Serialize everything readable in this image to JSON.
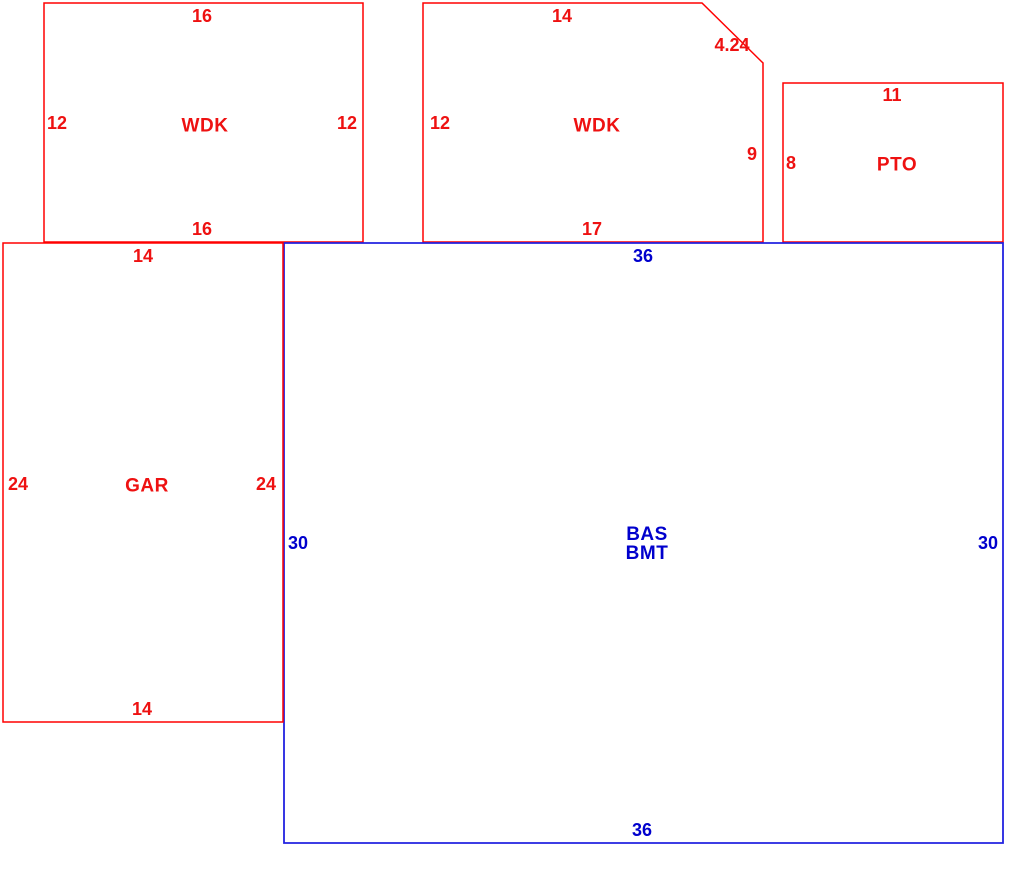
{
  "canvas": {
    "width": 1035,
    "height": 882,
    "background": "#ffffff"
  },
  "colors": {
    "exterior_red_line": "#ff0000",
    "exterior_red_text": "#ee1111",
    "main_blue_line": "#2222e0",
    "main_blue_text": "#0000cd"
  },
  "areas": [
    {
      "id": "wdk-left",
      "type": "wood-deck",
      "label_lines": [
        "WDK"
      ],
      "line_color": "#ff0000",
      "text_color": "#ee1111",
      "stroke_width": 1.5,
      "points": "44,3 363,3 363,242 44,242",
      "label_pos": {
        "x": 205,
        "y": 126
      },
      "dims": [
        {
          "text": "16",
          "x": 202,
          "y": 16,
          "side": "top"
        },
        {
          "text": "12",
          "x": 57,
          "y": 123,
          "side": "left"
        },
        {
          "text": "12",
          "x": 347,
          "y": 123,
          "side": "right"
        },
        {
          "text": "16",
          "x": 202,
          "y": 229,
          "side": "bottom"
        }
      ]
    },
    {
      "id": "wdk-mid",
      "type": "wood-deck",
      "label_lines": [
        "WDK"
      ],
      "line_color": "#ff0000",
      "text_color": "#ee1111",
      "stroke_width": 1.5,
      "points": "423,3 702,3 763,63 763,242 423,242",
      "label_pos": {
        "x": 597,
        "y": 126
      },
      "dims": [
        {
          "text": "14",
          "x": 562,
          "y": 16,
          "side": "top"
        },
        {
          "text": "4.24",
          "x": 732,
          "y": 45,
          "side": "diagonal"
        },
        {
          "text": "12",
          "x": 440,
          "y": 123,
          "side": "left"
        },
        {
          "text": "9",
          "x": 752,
          "y": 154,
          "side": "right"
        },
        {
          "text": "17",
          "x": 592,
          "y": 229,
          "side": "bottom"
        }
      ]
    },
    {
      "id": "pto",
      "type": "patio",
      "label_lines": [
        "PTO"
      ],
      "line_color": "#ff0000",
      "text_color": "#ee1111",
      "stroke_width": 1.5,
      "points": "783,83 1003,83 1003,242 783,242",
      "label_pos": {
        "x": 897,
        "y": 165
      },
      "dims": [
        {
          "text": "11",
          "x": 892,
          "y": 95,
          "side": "top"
        },
        {
          "text": "8",
          "x": 791,
          "y": 163,
          "side": "left"
        }
      ]
    },
    {
      "id": "bas-bmt",
      "type": "base-with-basement",
      "label_lines": [
        "BAS",
        "BMT"
      ],
      "line_color": "#2222e0",
      "text_color": "#0000cd",
      "stroke_width": 1.8,
      "points": "284,243 1003,243 1003,843 284,843",
      "label_pos": {
        "x": 647,
        "y": 544
      },
      "dims": [
        {
          "text": "36",
          "x": 643,
          "y": 256,
          "side": "top"
        },
        {
          "text": "30",
          "x": 298,
          "y": 543,
          "side": "left"
        },
        {
          "text": "30",
          "x": 988,
          "y": 543,
          "side": "right"
        },
        {
          "text": "36",
          "x": 642,
          "y": 830,
          "side": "bottom"
        }
      ]
    },
    {
      "id": "gar",
      "type": "garage",
      "label_lines": [
        "GAR"
      ],
      "line_color": "#ff0000",
      "text_color": "#ee1111",
      "stroke_width": 1.5,
      "points": "3,243 283,243 283,722 3,722",
      "label_pos": {
        "x": 147,
        "y": 486
      },
      "dims": [
        {
          "text": "14",
          "x": 143,
          "y": 256,
          "side": "top"
        },
        {
          "text": "24",
          "x": 18,
          "y": 484,
          "side": "left"
        },
        {
          "text": "24",
          "x": 266,
          "y": 484,
          "side": "right"
        },
        {
          "text": "14",
          "x": 142,
          "y": 709,
          "side": "bottom"
        }
      ]
    }
  ]
}
